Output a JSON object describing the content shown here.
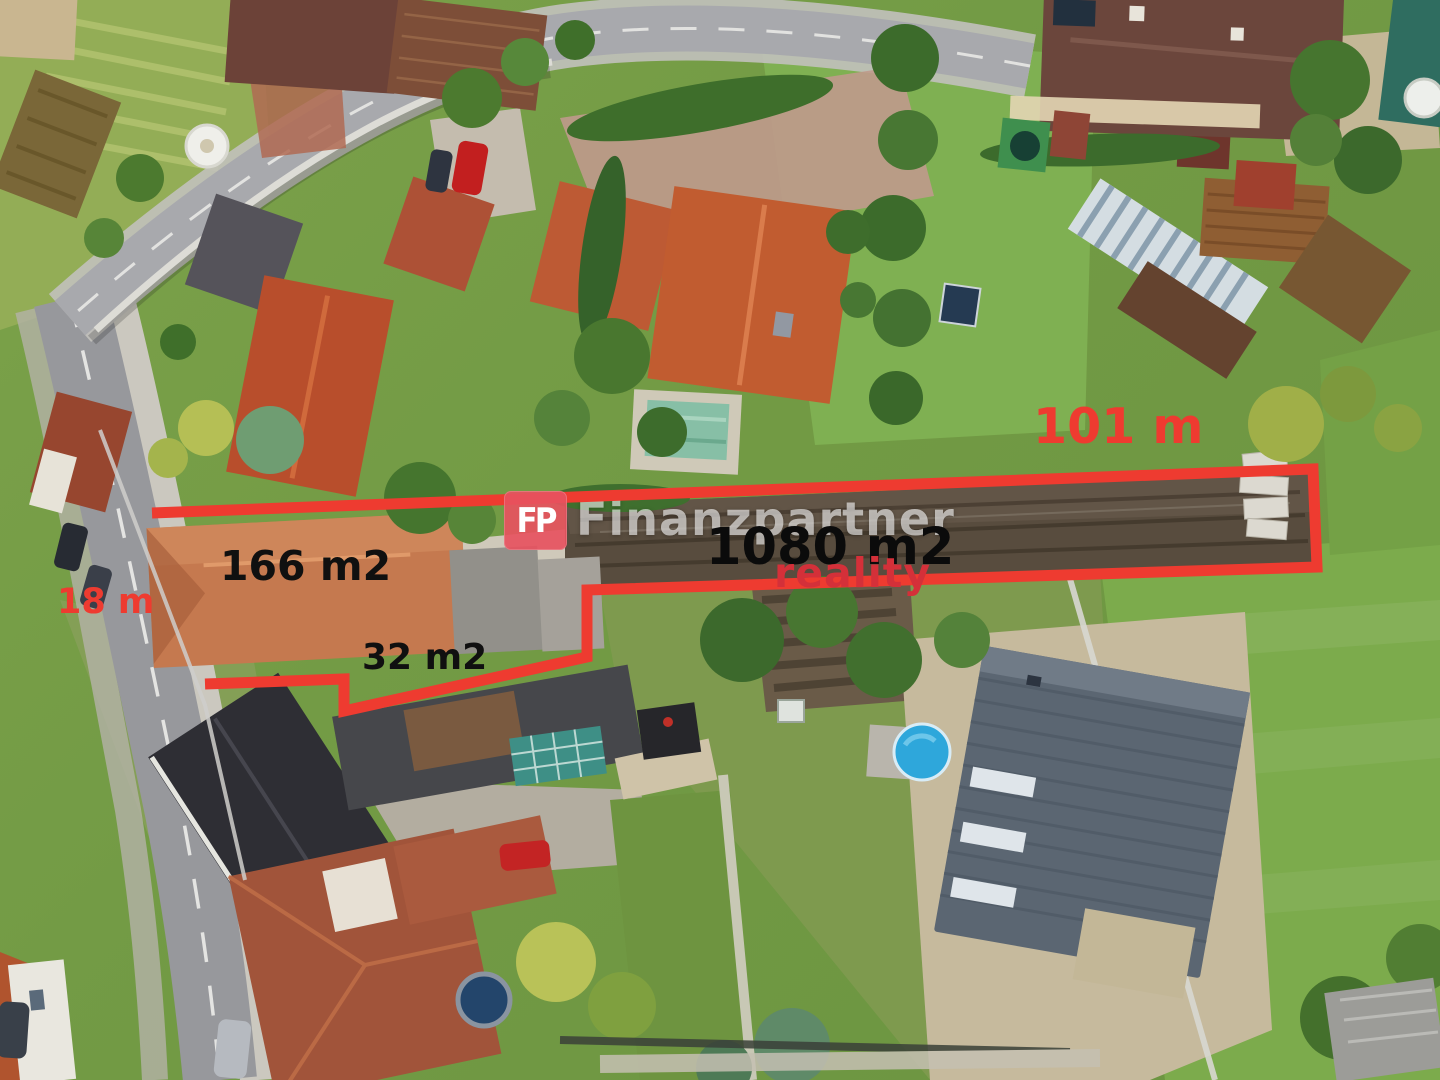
{
  "page": {
    "title": "Aerial property photo with plot measurements"
  },
  "annotations": {
    "street_frontage_label": "18 m",
    "plot_length_label": "101 m",
    "main_house_area_label": "166 m2",
    "outbuilding_area_label": "32 m2",
    "total_plot_area_label": "1080 m2"
  },
  "watermark": {
    "brand_name": "Finanzpartner",
    "brand_division": "reality",
    "logo_monogram": "FP"
  },
  "colors": {
    "annotation_red": "#ee3b30",
    "area_label_black": "#101010",
    "reality_red": "#d43039",
    "watermark_white": "rgba(255,255,255,0.60)",
    "logo_pink": "rgba(231,82,96,0.92)"
  }
}
